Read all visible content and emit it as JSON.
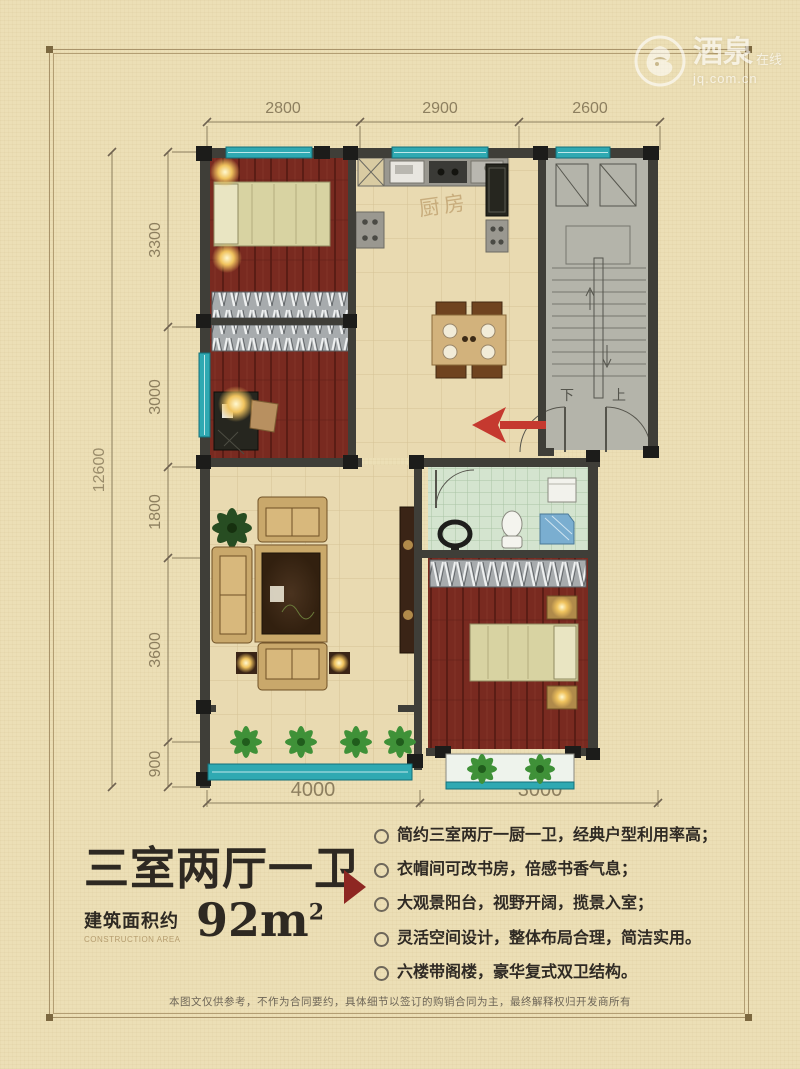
{
  "watermark": {
    "brand": "酒泉",
    "suffix": "在线",
    "domain": "jq.com.cn"
  },
  "dimensions": {
    "top": [
      "2800",
      "2900",
      "2600"
    ],
    "left": [
      "3300",
      "3000",
      "1800",
      "3600",
      "900"
    ],
    "left_total": "12600",
    "bottom": [
      "4000",
      "3000"
    ]
  },
  "plan_labels": {
    "kitchen": "厨房",
    "stair_down": "下",
    "stair_up": "上"
  },
  "info": {
    "title": "三室两厅一卫",
    "area_label": "建筑面积约",
    "area_label_en": "CONSTRUCTION AREA",
    "area_value": "92m",
    "area_sup": "2",
    "features": [
      "简约三室两厅一厨一卫，经典户型利用率高；",
      "衣帽间可改书房，倍感书香气息；",
      "大观景阳台，视野开阔，揽景入室；",
      "灵活空间设计，整体布局合理，简洁实用。",
      "六楼带阁楼，豪华复式双卫结构。"
    ]
  },
  "disclaimer": "本图文仅供参考，不作为合同要约，具体细节以签订的购销合同为主，最终解释权归开发商所有",
  "colors": {
    "page_bg": "#ecdfb6",
    "frame": "#a8936a",
    "wall": "#3f3e38",
    "window_teal": "#2fa9b2",
    "wood_floor": "#792a20",
    "tile_floor": "#e9dab1",
    "bath_tile": "#d4e4cf",
    "stair_gray": "#b4b4aa",
    "arrow_red": "#c5392f",
    "marker_red": "#8e2722",
    "title_text": "#2e2922"
  }
}
